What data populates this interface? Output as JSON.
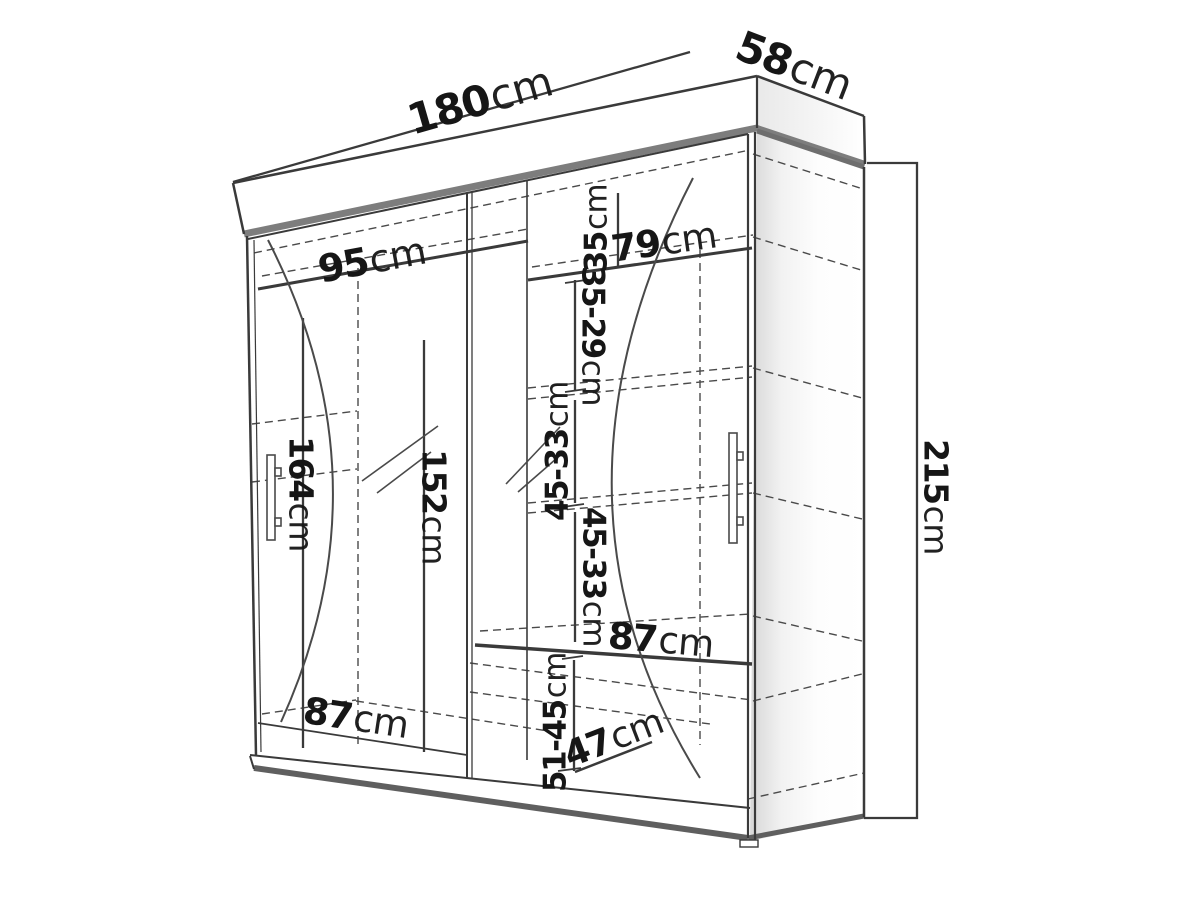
{
  "diagram_title": "wardrobe-dimension-diagram",
  "colors": {
    "line": "#3a3a3a",
    "thick_edge_gray": "#7d7d7d",
    "plinth_gray": "#5f5f5f",
    "dashed_line": "#4a4a4a",
    "background": "#ffffff",
    "side_shade": "#d7d7d7"
  },
  "dimensions": {
    "width_total": {
      "value": "180",
      "unit": "cm"
    },
    "depth_total": {
      "value": "58",
      "unit": "cm"
    },
    "height_total": {
      "value": "215",
      "unit": "cm"
    },
    "left_section_width": {
      "value": "95",
      "unit": "cm"
    },
    "right_section_width": {
      "value": "79",
      "unit": "cm"
    },
    "top_cubby_height": {
      "value": "35",
      "unit": "cm"
    },
    "shelf_gap_top": {
      "value": "35-29",
      "unit": "cm"
    },
    "shelf_gap_upper": {
      "value": "45-33",
      "unit": "cm"
    },
    "shelf_gap_lower": {
      "value": "45-33",
      "unit": "cm"
    },
    "left_interior_height": {
      "value": "164",
      "unit": "cm"
    },
    "mirror_height": {
      "value": "152",
      "unit": "cm"
    },
    "left_bottom_width": {
      "value": "87",
      "unit": "cm"
    },
    "right_shelf_width": {
      "value": "87",
      "unit": "cm"
    },
    "bottom_section_height": {
      "value": "51-45",
      "unit": "cm"
    },
    "bottom_shelf_depth": {
      "value": "47",
      "unit": "cm"
    }
  }
}
